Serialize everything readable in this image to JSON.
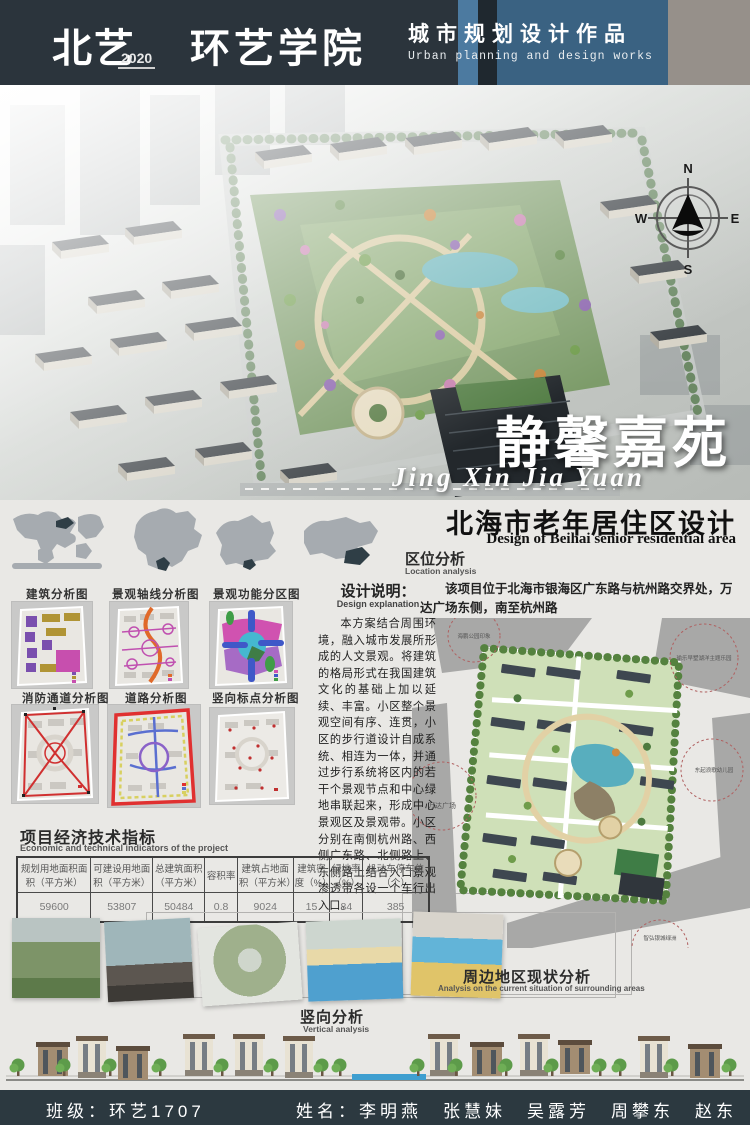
{
  "header": {
    "logo_cn": "北艺",
    "logo_year": "2020",
    "logo_dept": "环艺学院",
    "title_cn": "城市规划设计作品",
    "title_en": "Urban planning and design works"
  },
  "hero": {
    "project_title_cn": "静馨嘉苑",
    "project_title_pinyin": "Jing Xin Jia Yuan",
    "compass": {
      "n": "N",
      "e": "E",
      "s": "S",
      "w": "W"
    }
  },
  "subtitle": {
    "cn": "北海市老年居住区设计",
    "en": "Design of Beihai senior residential area"
  },
  "location": {
    "title": "区位分析",
    "subtitle": "Location analysis",
    "body": "该项目位于北海市银海区广东路与杭州路交界处，万达广场东侧，南至杭州路",
    "plan_labels": {
      "park": "海鹏公园印象",
      "resort": "瑜乐早墅湖洋主题乐园",
      "wanda": "万达广场",
      "kindergarten": "东起浪歌幼儿园",
      "oasis": "智弘银城绿洲"
    }
  },
  "design_explanation": {
    "title": "设计说明：",
    "subtitle": "Design explanation",
    "body": "本方案结合周围环境，融入城市发展所形成的人文景观。将建筑的格局形式在我国建筑文化的基础上加以延续、丰富。小区整个景观空间有序、连贯，小区的步行道设计自成系统、相连为一体，并通过步行系统将区内的若干个景观节点和中心绿地串联起来，形成中心景观区及景观带。小区分别在南侧杭州路、西侧广东路、北侧路上、东侧路上结合入口景观渗透带各设一个车行出入口。"
  },
  "diagrams": {
    "row1": [
      "建筑分析图",
      "景观轴线分析图",
      "景观功能分区图"
    ],
    "row2": [
      "消防通道分析图",
      "道路分析图",
      "竖向标点分析图"
    ]
  },
  "indicators": {
    "title": "项目经济技术指标",
    "subtitle": "Economic and technical indicators of the project",
    "columns": [
      "规划用地面积面积（平方米）",
      "可建设用地面积（平方米）",
      "总建筑面积（平方米）",
      "容积率",
      "建筑占地面积（平方米）",
      "建筑密度（%）",
      "绿地率（%）",
      "机动车停车位（个）"
    ],
    "values": [
      "59600",
      "53807",
      "50484",
      "0.8",
      "9024",
      "15",
      "84",
      "385"
    ]
  },
  "surrounding": {
    "title": "周边地区现状分析",
    "subtitle": "Analysis on the current situation of surrounding areas"
  },
  "vertical": {
    "title": "竖向分析",
    "subtitle": "Vertical analysis"
  },
  "footer": {
    "class_label": "班级：环艺1707",
    "names_label": "姓名：李明燕　张慧妹　吴露芳　周攀东　赵东明"
  }
}
